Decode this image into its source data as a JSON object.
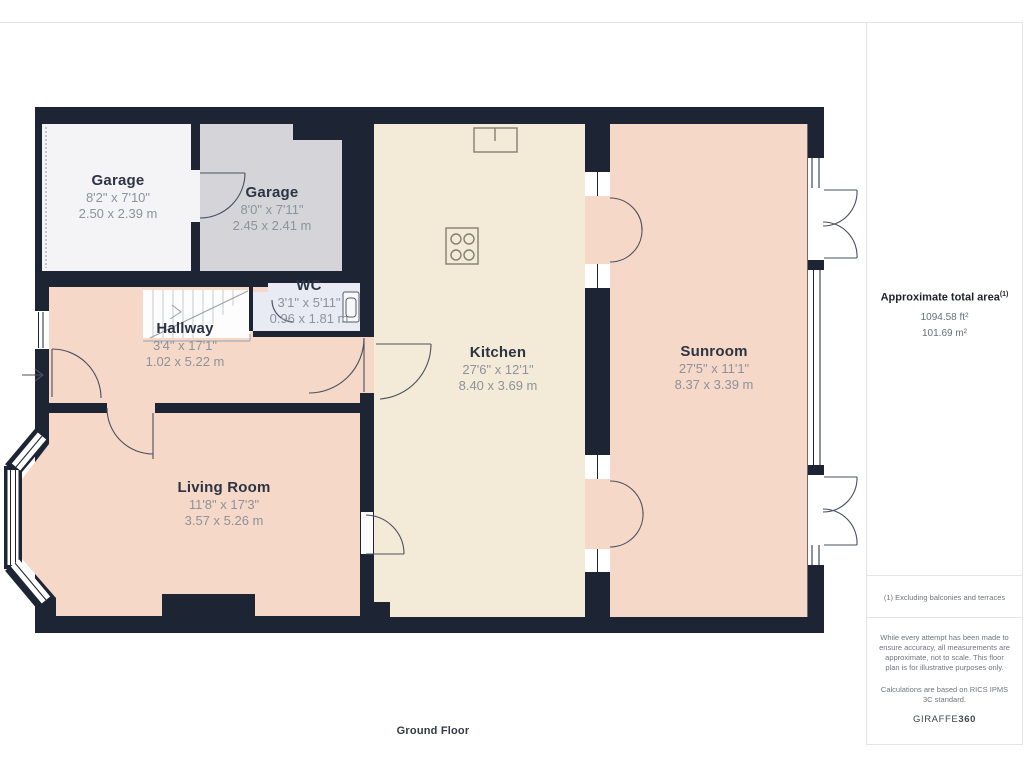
{
  "rooms": [
    {
      "name": "Garage",
      "imperial": "8'2\" x 7'10\"",
      "metric": "2.50 x 2.39 m"
    },
    {
      "name": "Garage",
      "imperial": "8'0\" x 7'11\"",
      "metric": "2.45 x 2.41 m"
    },
    {
      "name": "WC",
      "imperial": "3'1\" x 5'11\"",
      "metric": "0.96 x 1.81 m"
    },
    {
      "name": "Hallway",
      "imperial": "3'4\" x 17'1\"",
      "metric": "1.02 x 5.22 m"
    },
    {
      "name": "Kitchen",
      "imperial": "27'6\" x 12'1\"",
      "metric": "8.40 x 3.69 m"
    },
    {
      "name": "Sunroom",
      "imperial": "27'5\" x 11'1\"",
      "metric": "8.37 x 3.39 m"
    },
    {
      "name": "Living Room",
      "imperial": "11'8\" x 17'3\"",
      "metric": "3.57 x 5.26 m"
    }
  ],
  "floor_label": "Ground Floor",
  "sidebar": {
    "area_title": "Approximate total area",
    "area_superscript": "(1)",
    "area_ft": "1094.58 ft²",
    "area_m": "101.69 m²",
    "footnote": "(1) Excluding balconies and terraces",
    "disclaimer": "While every attempt has been made to ensure accuracy, all measurements are approximate, not to scale. This floor plan is for illustrative purposes only.",
    "standard": "Calculations are based on RICS IPMS 3C standard.",
    "brand_normal": "GIRAFFE",
    "brand_bold": "360"
  },
  "colors": {
    "wall": "#1d2433",
    "peach": "#f5d8c7",
    "cream": "#f3ebd8",
    "g1": "#f4f4f6",
    "g2": "#d5d5d9",
    "wc": "#e9ebf4",
    "line": "#4a5060",
    "dim": "#8d929c",
    "name": "#2c3444",
    "rule": "#e4e4e6"
  }
}
